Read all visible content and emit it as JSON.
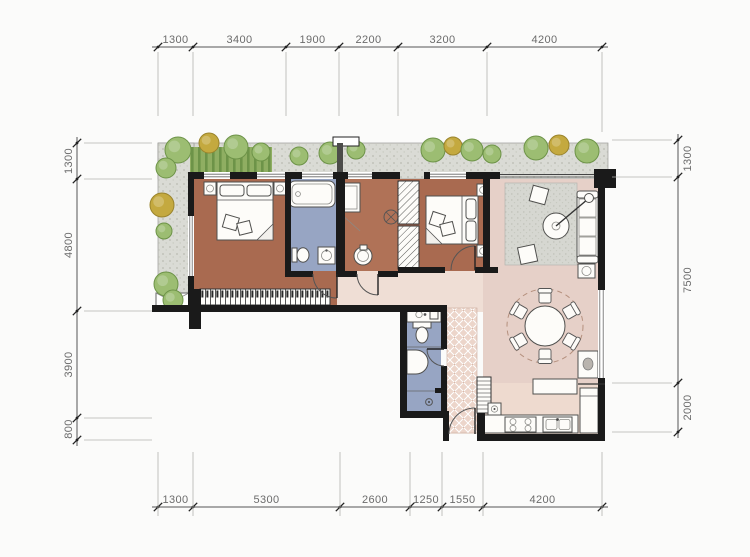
{
  "title": "apartment-floor-plan",
  "dimensions": {
    "top": [
      "1300",
      "3400",
      "1900",
      "2200",
      "3200",
      "4200"
    ],
    "bottom": [
      "1300",
      "5300",
      "2600",
      "1250",
      "1550",
      "4200"
    ],
    "left": [
      "1300",
      "4800",
      "3900",
      "800"
    ],
    "right": [
      "1300",
      "7500",
      "2000"
    ]
  },
  "palette": {
    "wall": "#1a1a1a",
    "bedroom_floor": "#a96a50",
    "corridor_floor": "#b07257",
    "bath_floor": "#97a5c3",
    "living_floor": "#e6d0c8",
    "hall_floor": "#efded5",
    "kitchen_floor": "#eedacf",
    "terrace_gravel": "#d9dad4",
    "hedge_green": "#8fae62",
    "tree_green": "#9cbd72",
    "tree_olive": "#c4a93f",
    "dimension_text": "#6b6b6b"
  },
  "icons": [
    "tree-icon",
    "hedge-icon",
    "double-bed-icon",
    "nightstand-icon",
    "wardrobe-icon",
    "bathtub-icon",
    "toilet-icon",
    "washbasin-icon",
    "shower-drain-icon",
    "sofa-icon",
    "coffee-table-icon",
    "floor-lamp-icon",
    "ottoman-icon",
    "dining-table-icon",
    "dining-chair-icon",
    "bar-counter-icon",
    "stove-icon",
    "kitchen-sink-icon",
    "fridge-icon",
    "tall-cabinet-icon",
    "door-swing-icon",
    "window-icon",
    "entry-mat-icon",
    "ac-platform-icon",
    "plant-icon",
    "dresser-icon"
  ]
}
